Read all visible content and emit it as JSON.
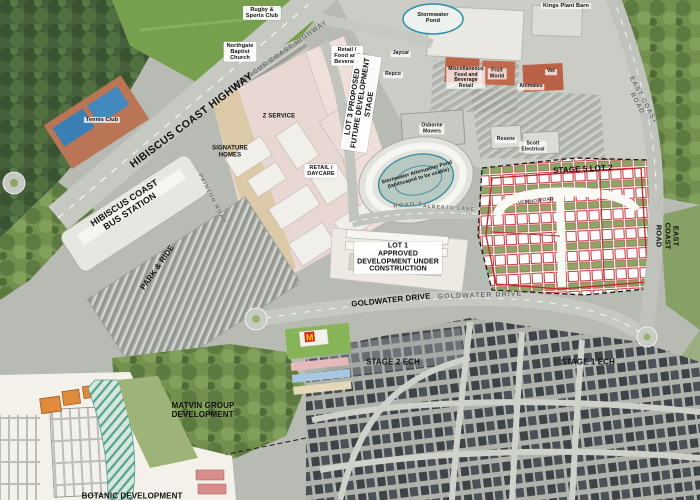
{
  "map": {
    "labels": {
      "rugby_sports_club": "Rugby &\nSports Club",
      "northgate_baptist_church": "Northgate\nBaptist\nChurch",
      "hibiscus_coast_highway_roadname": "HIBISCUS COAST HIGHWAY",
      "stormwater_pond": "Stormwater\nPond",
      "kings_plant_barn": "Kings Plant Barn",
      "retail_food_beverage": "Retail /\nFood and\nBeverage",
      "jaycar": "Jaycar",
      "repco": "Repco",
      "misc_food_beverage_retail": "Miscellaneous\nFood and\nBeverage\nRetail",
      "fruit_world": "Fruit\nWorld",
      "animates": "Animates",
      "vet": "Vet",
      "tennis_club": "Tennis Club",
      "hibiscus_coast_highway": "HIBISCUS COAST HIGHWAY",
      "z_service": "Z SERVICE",
      "signature_homes": "SIGNATURE\nHOMES",
      "retail_daycare": "RETAIL /\nDAYCARE",
      "lot3_proposed": "LOT 3 PROPOSED\nFUTURE DEVELOPMENT\nSTAGE",
      "osborne_movers": "Osborne\nMovers",
      "resene": "Resene",
      "scott_electrical": "Scott\nElectrical",
      "east_coast_road_roadname": "EAST COAST ROAD",
      "stage5_lot2": "STAGE 5 LOT 2",
      "veeino_road": "VEEINO ROAD",
      "attenuation_pond": "Stormwater Attenuation Pond\n(landscaped to be usable)",
      "road_3": "ROAD 3",
      "alberto_lane": "ALBERTO LANE",
      "painton_road": "PAINTON ROAD",
      "bus_station": "HIBISCUS COAST\nBUS STATION",
      "park_and_ride": "PARK & RIDE",
      "lot1_approved": "LOT 1\nAPPROVED\nDEVELOPMENT UNDER\nCONSTRUCTION",
      "goldwater_drive": "GOLDWATER DRIVE",
      "goldwater_drive_roadname": "GOLDWATER DRIVE",
      "east_coast_road": "EAST COAST ROAD",
      "stage2_ech": "STAGE 2 ECH",
      "stage1_ech": "STAGE 1 ECH",
      "matvin_group": "MATVIN GROUP\nDEVELOPMENT",
      "botanic_development": "BOTANIC DEVELOPMENT"
    },
    "icons": {
      "mcdonalds_glyph": "M"
    },
    "colors": {
      "stage_boundary_red": "#c1272d",
      "pond_outline_teal": "#2e8fa6",
      "dashed_boundary_black": "#1a1a1a",
      "road_gray": "#c6c8c2",
      "field_green": "#77a04e"
    }
  }
}
